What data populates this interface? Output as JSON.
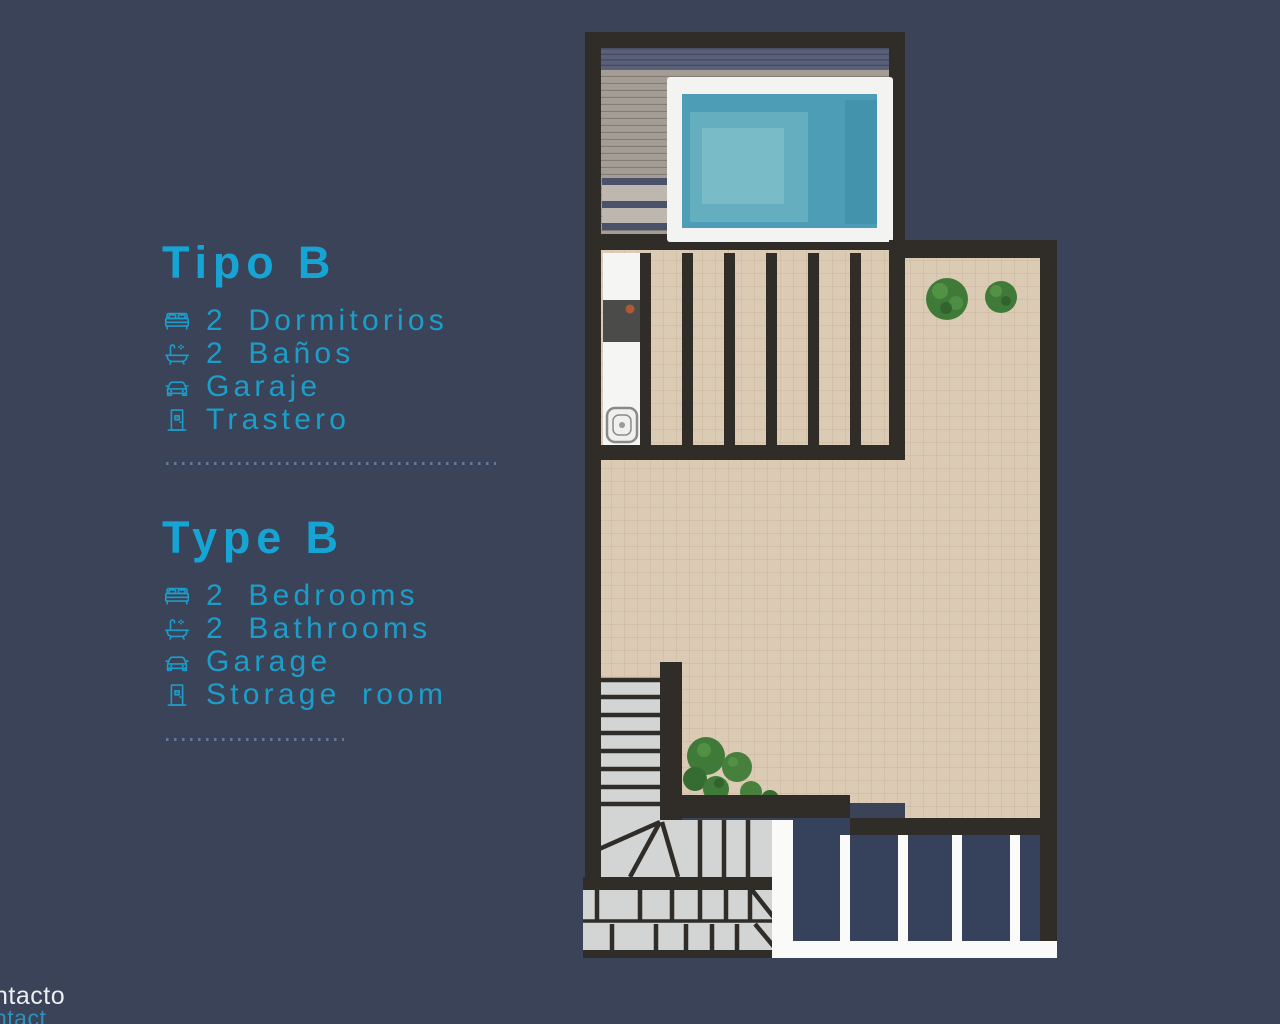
{
  "theme": {
    "background": "#3a4357",
    "accent": "#1d9dc9",
    "heading_accent": "#16a4d4",
    "wall": "#302c28",
    "tile": "#dbcbb5",
    "tile_grout": "#c9b59c",
    "deck": "#a39d95",
    "deck_band": "#596077",
    "pool_frame": "#f3f4f2",
    "pool_water": "#4e9db6",
    "stairs": "#d3d5d4",
    "railing_white": "#fafaf8",
    "lower_floor": "#36415c",
    "dotted_line": "#5d7a99",
    "footer_white": "#eceef1",
    "footer_link": "#2b91bf"
  },
  "sections": [
    {
      "title": "Tipo B",
      "items": [
        {
          "icon": "bed-icon",
          "label": "2 Dormitorios"
        },
        {
          "icon": "bathtub-icon",
          "label": "2 Baños"
        },
        {
          "icon": "car-icon",
          "label": "Garaje"
        },
        {
          "icon": "door-icon",
          "label": "Trastero"
        }
      ]
    },
    {
      "title": "Type B",
      "items": [
        {
          "icon": "bed-icon",
          "label": "2 Bedrooms"
        },
        {
          "icon": "bathtub-icon",
          "label": "2 Bathrooms"
        },
        {
          "icon": "car-icon",
          "label": "Garage"
        },
        {
          "icon": "door-icon",
          "label": "Storage room"
        }
      ]
    }
  ],
  "footer": {
    "line1": "ntacto",
    "line2": "ntact"
  },
  "floor_plan": {
    "features": [
      "pool",
      "wood-deck",
      "pergola",
      "outdoor-kitchen",
      "tiled-terrace",
      "plants",
      "staircase",
      "lower-level-railing"
    ]
  }
}
